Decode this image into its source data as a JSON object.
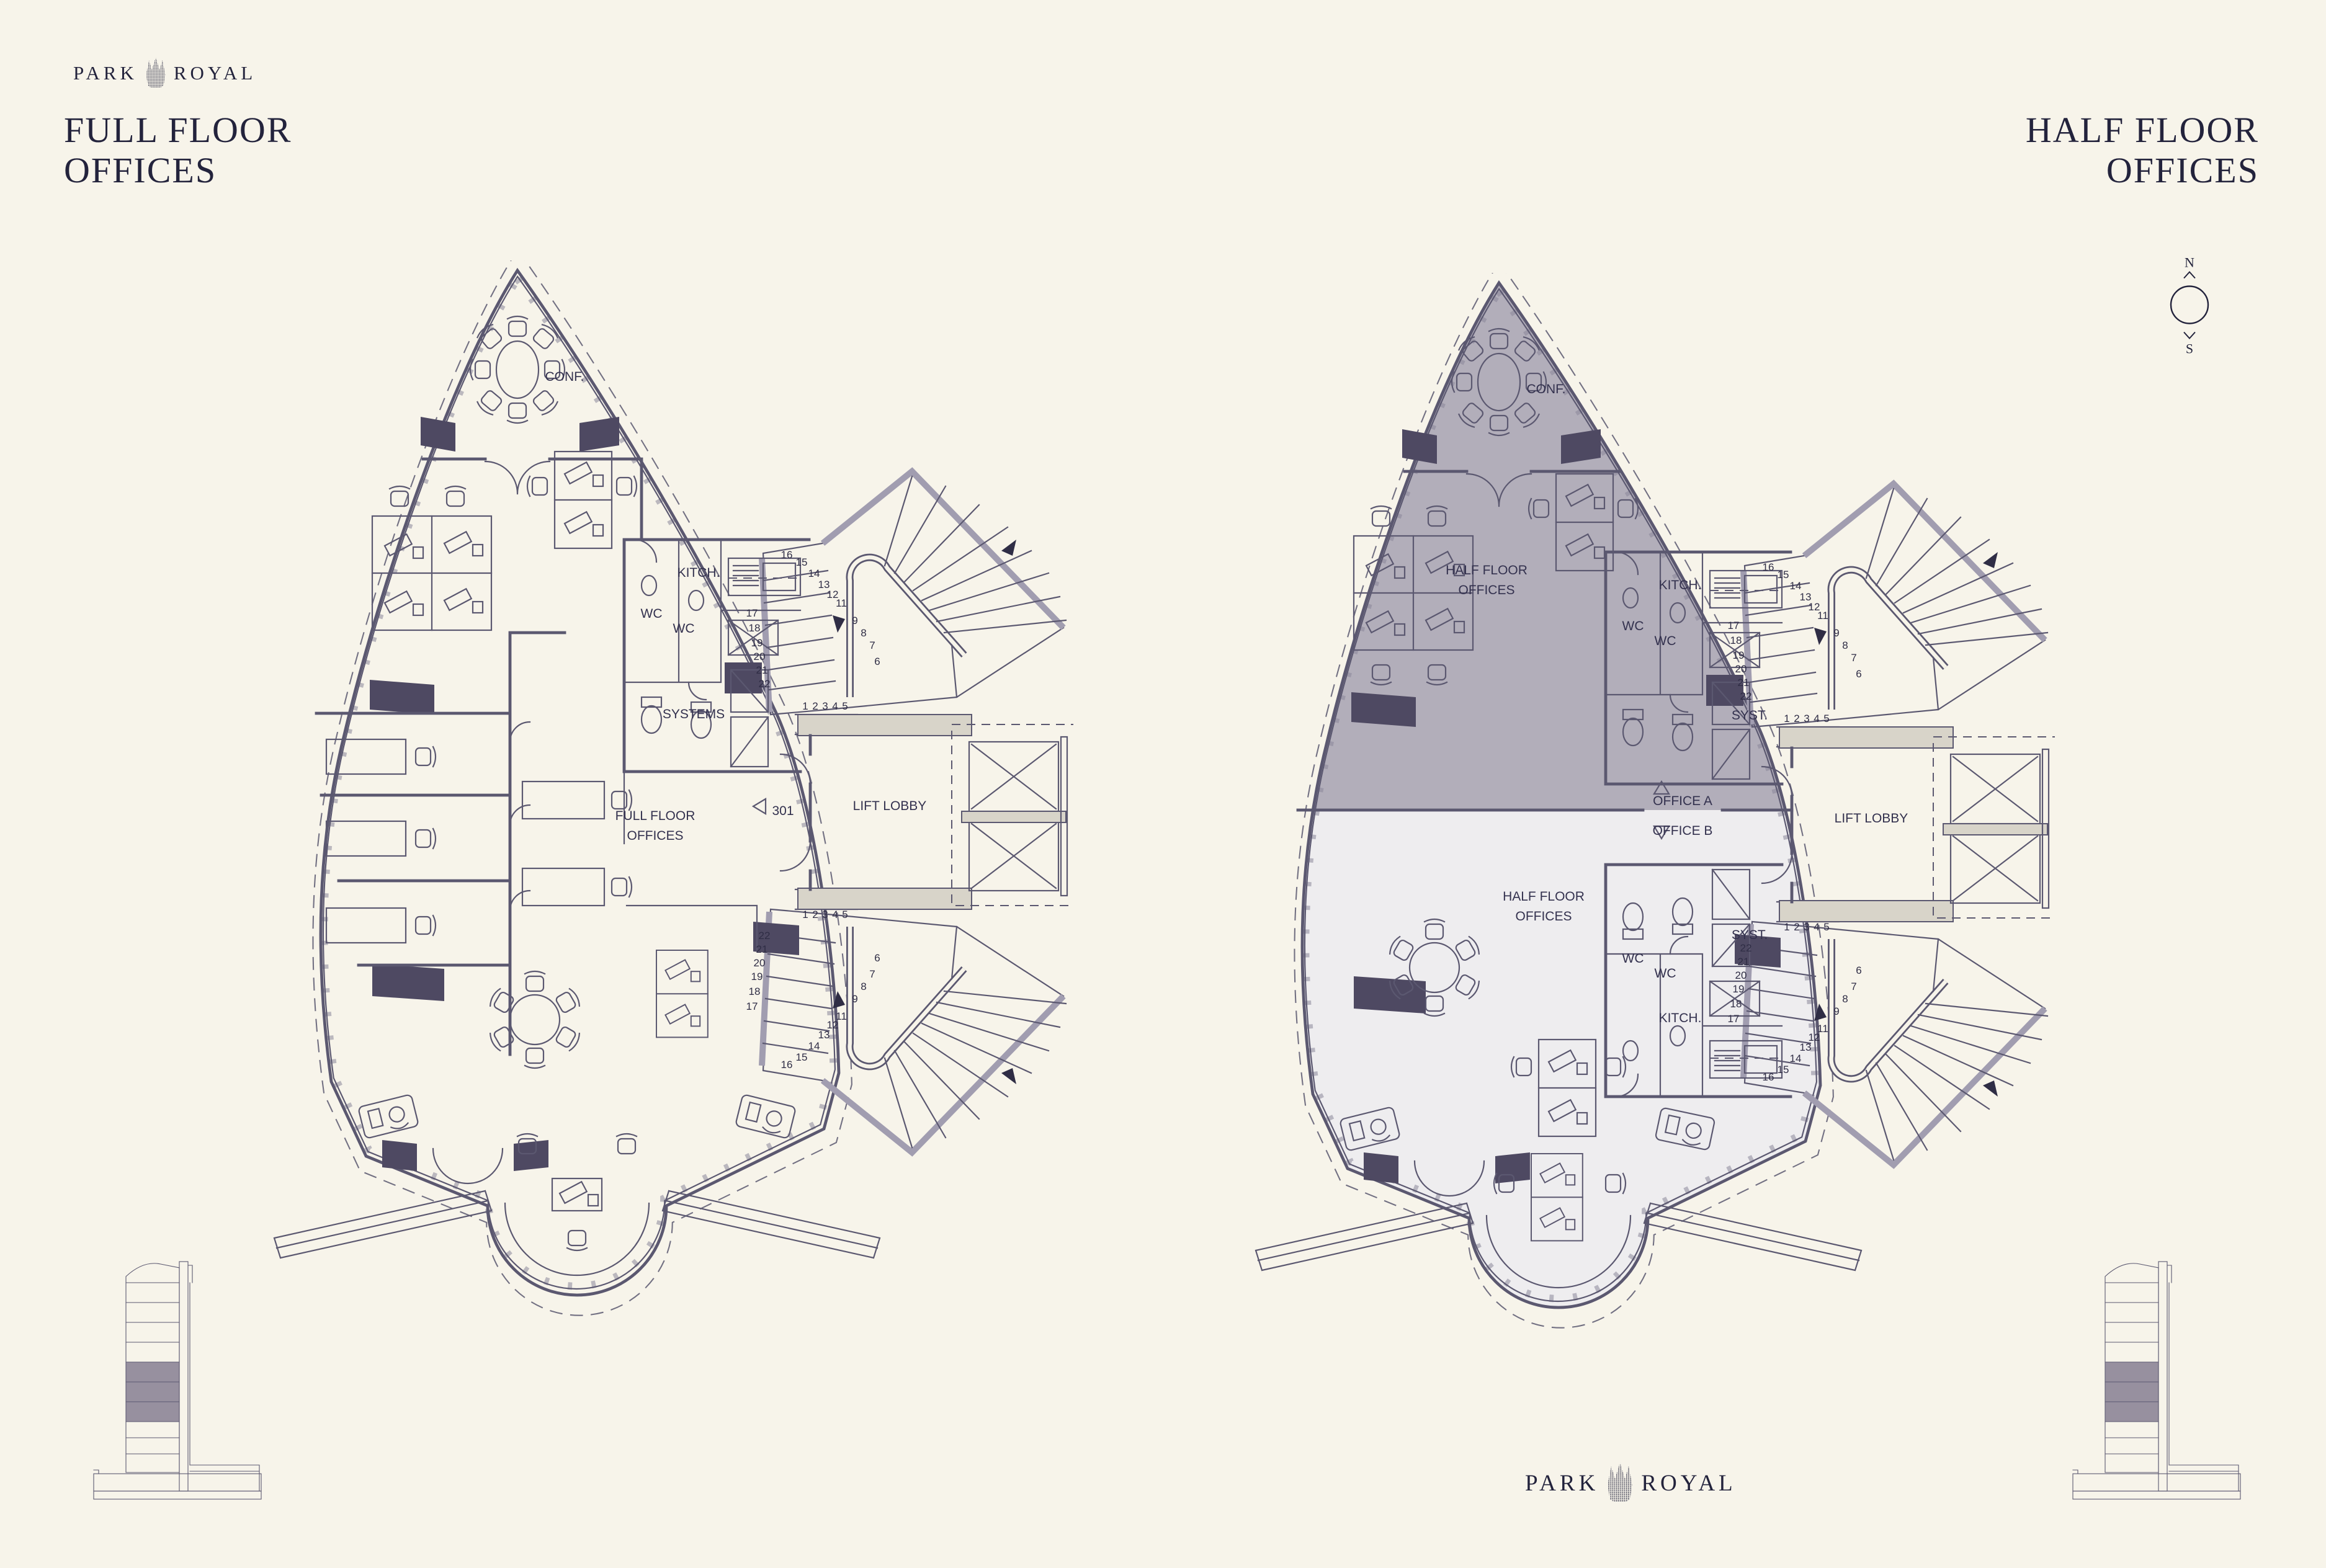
{
  "brand": {
    "park": "PARK",
    "royal": "ROYAL"
  },
  "titles": {
    "left_line1": "FULL FLOOR",
    "left_line2": "OFFICES",
    "right_line1": "HALF FLOOR",
    "right_line2": "OFFICES"
  },
  "compass": {
    "north": "N",
    "south": "S"
  },
  "stair_numbers": {
    "run1": [
      "16",
      "15",
      "14",
      "13",
      "12",
      "11"
    ],
    "run2": [
      "9",
      "8",
      "7",
      "6"
    ],
    "run3": [
      "17",
      "18",
      "19",
      "20",
      "21",
      "22"
    ],
    "run4": [
      "1",
      "2",
      "3",
      "4",
      "5"
    ]
  },
  "left_plan": {
    "labels": {
      "conference": "CONF.",
      "kitchen": "KITCH.",
      "wc": "WC",
      "systems": "SYSTEMS",
      "office_line1": "FULL FLOOR",
      "office_line2": "OFFICES",
      "lift_lobby": "LIFT LOBBY",
      "unit_number": "301"
    }
  },
  "right_plan": {
    "labels": {
      "conference": "CONF.",
      "kitchen": "KITCH.",
      "wc": "WC",
      "syst": "SYST.",
      "office_a": "OFFICE A",
      "office_b": "OFFICE B",
      "lift_lobby": "LIFT LOBBY",
      "half_floor_line1": "HALF FLOOR",
      "half_floor_line2": "OFFICES"
    }
  },
  "colors": {
    "background": "#f7f4ea",
    "ink": "#23233c",
    "cad_line": "#5b5870",
    "wall_fill": "#4e4962",
    "shade_upper_half": "#b2aeba",
    "shade_lower_half": "#eeedef",
    "building_floor_shade": "#97909f",
    "concrete": "#d8d4c9"
  }
}
